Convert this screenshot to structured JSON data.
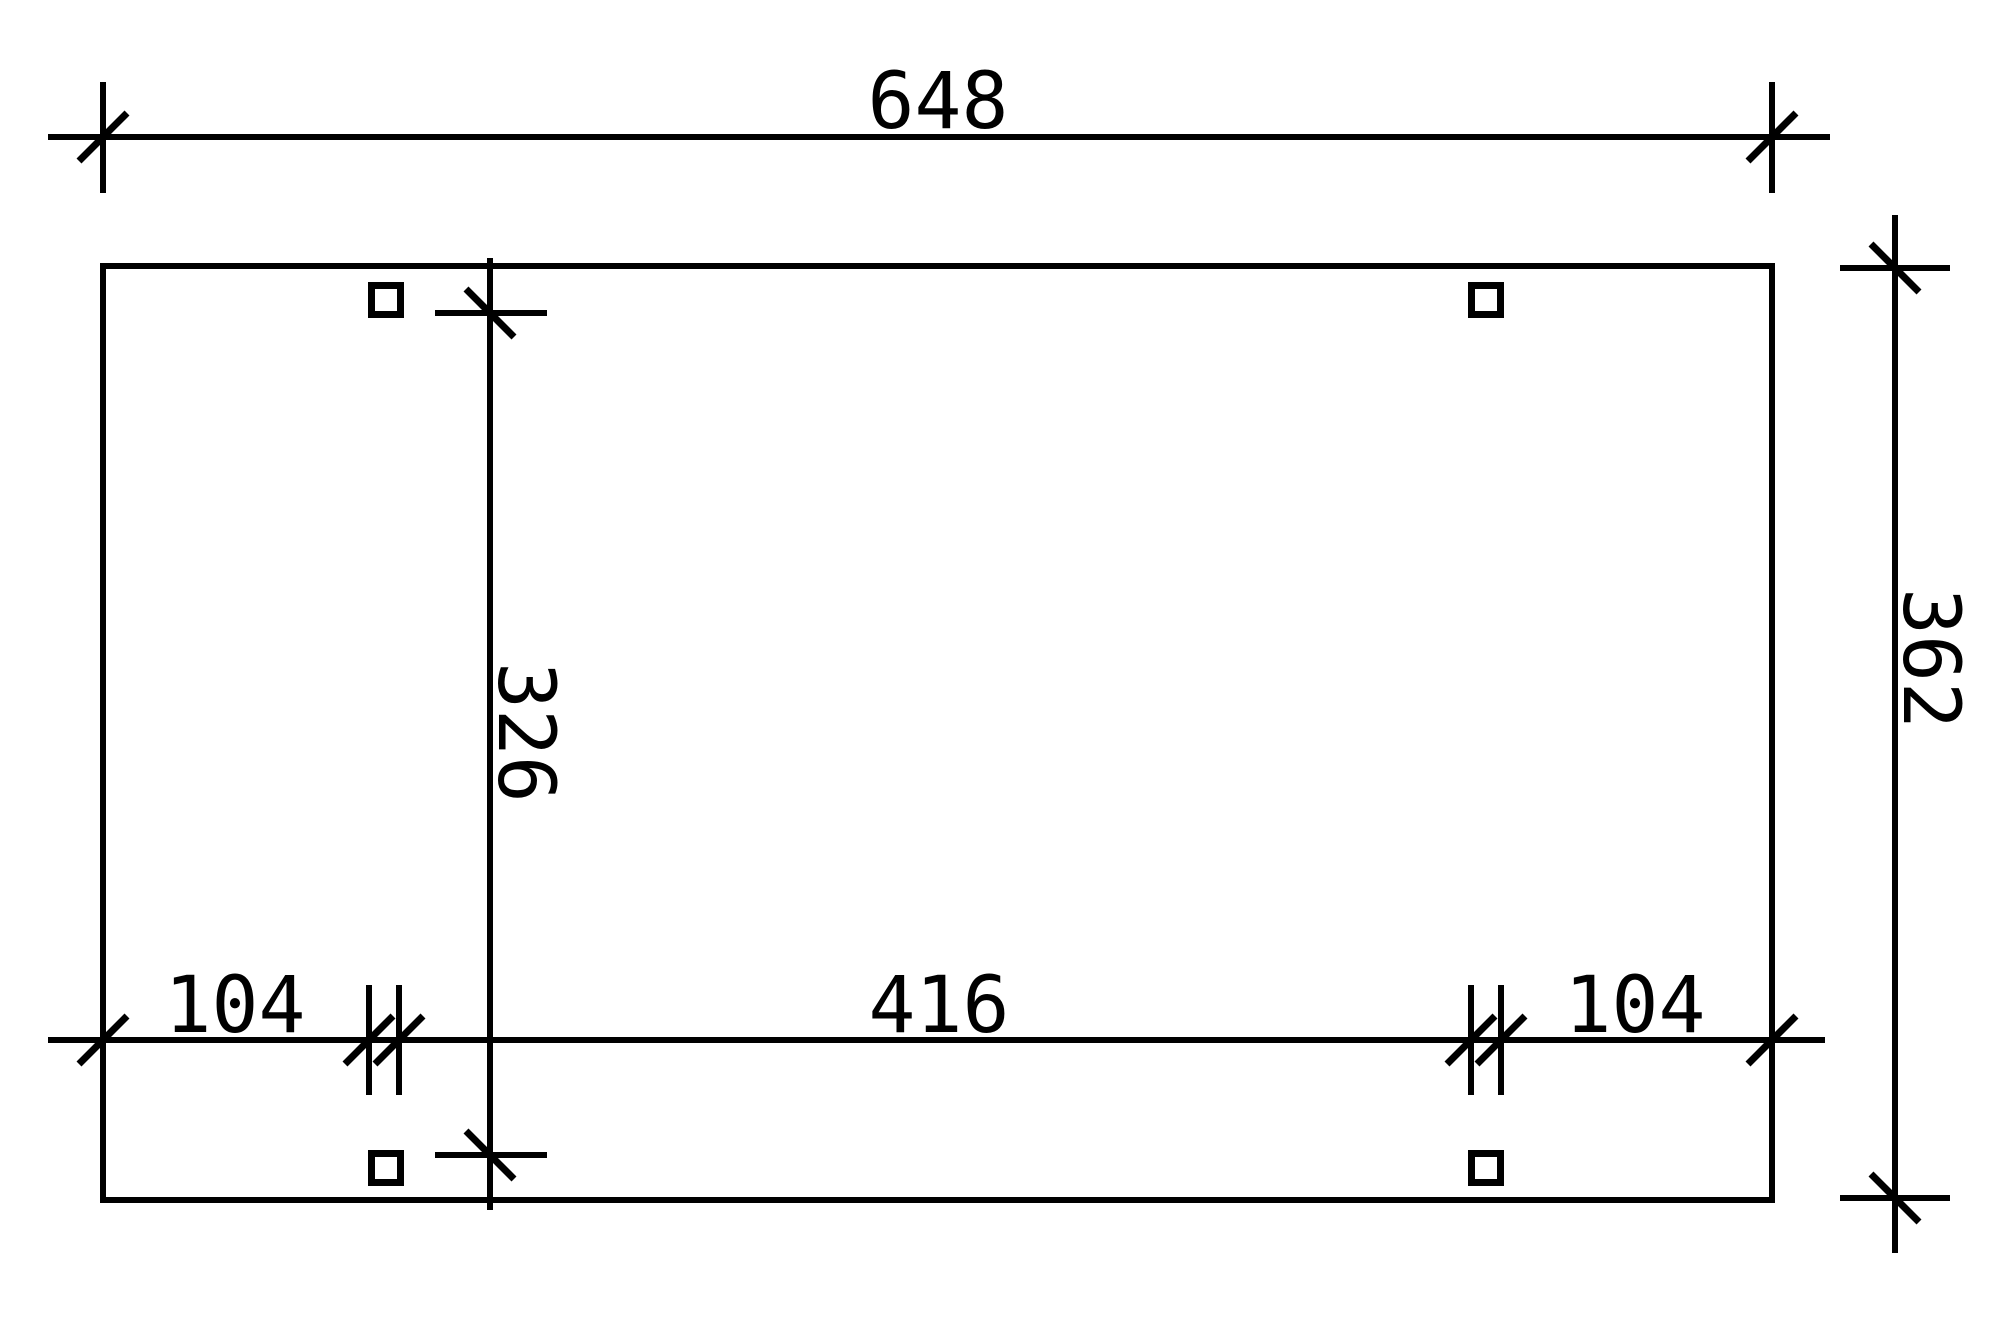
{
  "drawing": {
    "description": "carport ground plan",
    "colors": {
      "line": "#000000",
      "background": "#ffffff"
    },
    "dimensions": {
      "top": "648",
      "right": "362",
      "inner": "326",
      "bottom_left": "104",
      "bottom_center": "416",
      "bottom_right": "104"
    }
  }
}
